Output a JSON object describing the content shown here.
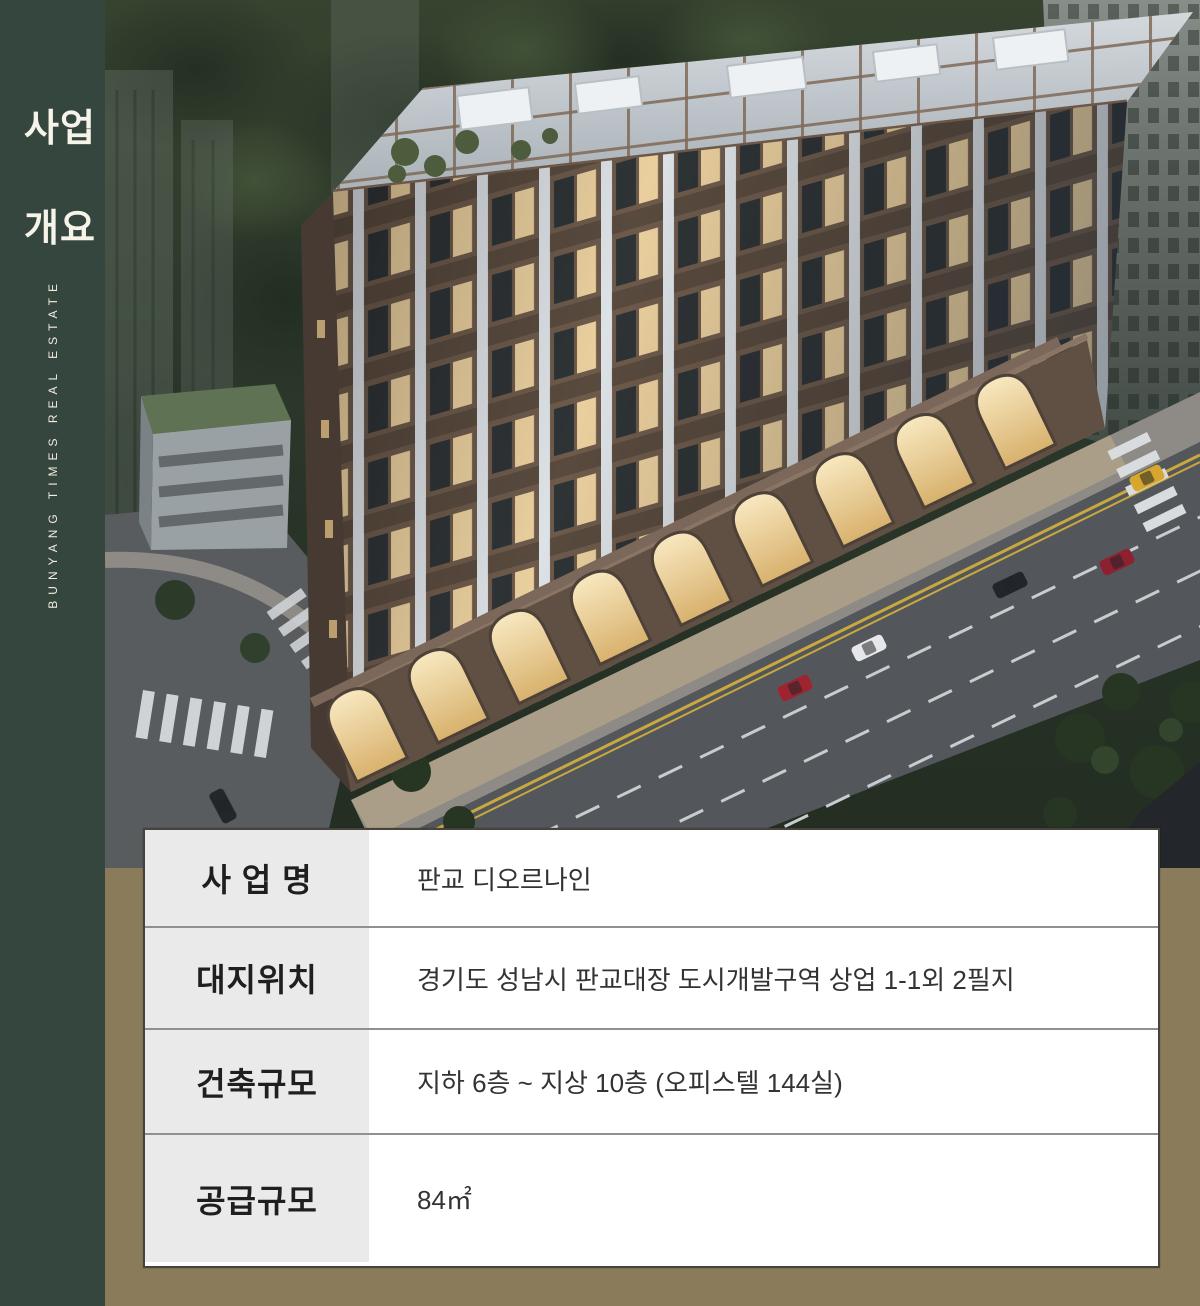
{
  "sidebar": {
    "title_line1": "사업",
    "title_line2": "개요",
    "brand": "BUNYANG TIMES REAL ESTATE"
  },
  "info_table": {
    "rows": [
      {
        "label": "사 업 명",
        "value": "판교 디오르나인"
      },
      {
        "label": "대지위치",
        "value": "경기도 성남시 판교대장 도시개발구역 상업 1-1외 2필지"
      },
      {
        "label": "건축규모",
        "value": "지하 6층 ~ 지상 10층 (오피스텔 144실)"
      },
      {
        "label": "공급규모",
        "value": "84㎡"
      }
    ]
  },
  "colors": {
    "sidebar_green": "#34463E",
    "panel_olive": "#8A7B5A",
    "label_cell_bg": "#EAEAEA",
    "table_border": "#45433B",
    "row_divider": "#909090",
    "text_dark": "#2B2B2B",
    "sidebar_text": "#F2EDE0"
  }
}
